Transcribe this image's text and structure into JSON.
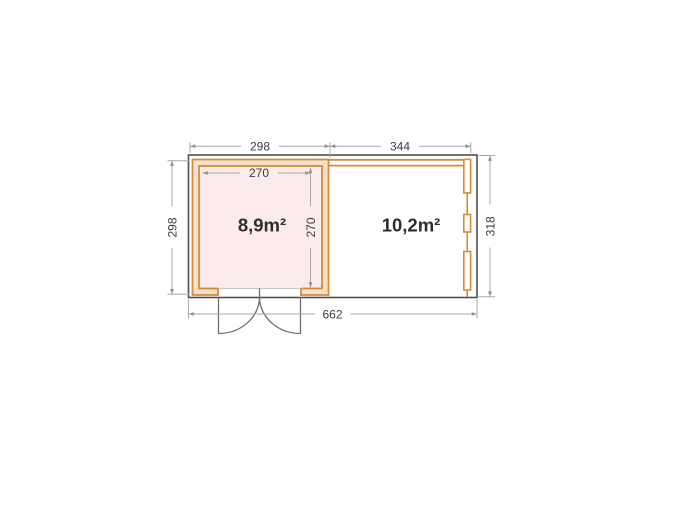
{
  "floor_plan": {
    "left_room": {
      "area": "8,9m²",
      "width_label": "298",
      "depth_label": "298",
      "inner_width_label": "270",
      "inner_depth_label": "270"
    },
    "right_room": {
      "area": "10,2m²",
      "width_label": "344",
      "depth_label": "318"
    },
    "total_width_label": "662",
    "colors": {
      "wall_orange": "#d88c3a",
      "wall_band_fill": "#f3e2cb",
      "left_room_fill": "#fcebeb",
      "building_outline": "#4f4f4f",
      "dimension_line": "#a8a8a8",
      "dimension_text": "#3c3c3c",
      "door_swing": "#6f6f6f",
      "background": "#ffffff"
    }
  }
}
